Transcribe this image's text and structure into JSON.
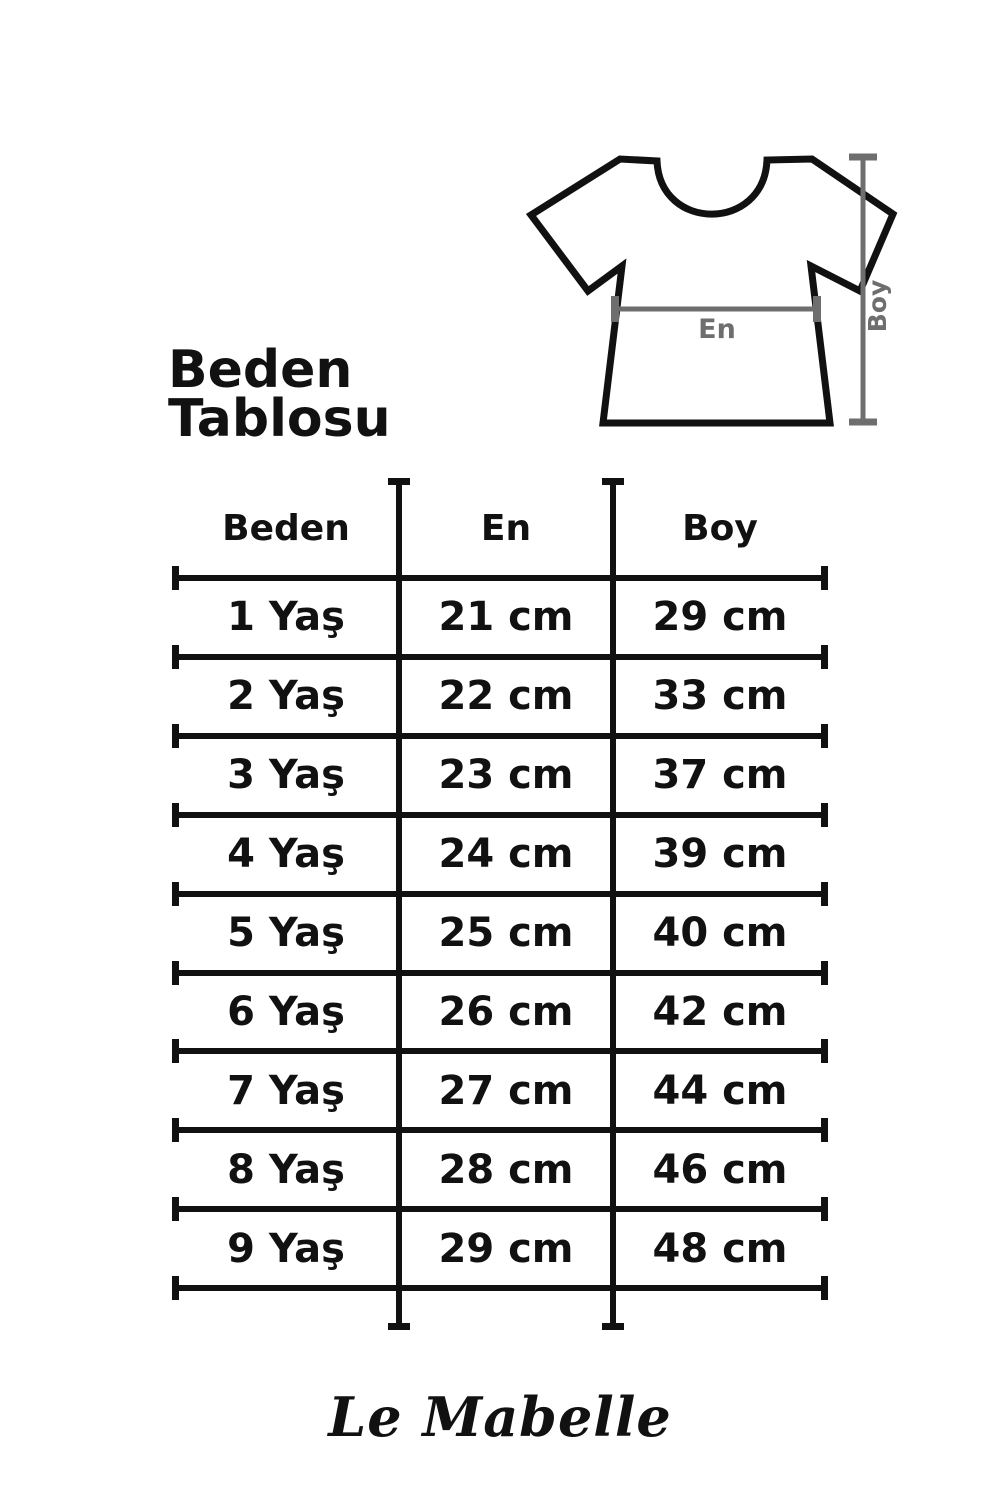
{
  "page": {
    "background": "#ffffff"
  },
  "title": {
    "line1": "Beden",
    "line2": "Tablosu"
  },
  "diagram": {
    "width_label": "En",
    "height_label": "Boy",
    "outline_color": "#111111",
    "measure_color": "#6e6e6e"
  },
  "table": {
    "headers": [
      "Beden",
      "En",
      "Boy"
    ],
    "rows": [
      [
        "1 Yaş",
        "21 cm",
        "29 cm"
      ],
      [
        "2 Yaş",
        "22 cm",
        "33 cm"
      ],
      [
        "3 Yaş",
        "23 cm",
        "37 cm"
      ],
      [
        "4 Yaş",
        "24 cm",
        "39 cm"
      ],
      [
        "5 Yaş",
        "25 cm",
        "40 cm"
      ],
      [
        "6 Yaş",
        "26 cm",
        "42 cm"
      ],
      [
        "7 Yaş",
        "27 cm",
        "44 cm"
      ],
      [
        "8 Yaş",
        "28 cm",
        "46 cm"
      ],
      [
        "9 Yaş",
        "29 cm",
        "48 cm"
      ]
    ]
  },
  "footer": {
    "brand": "Le Mabelle"
  }
}
